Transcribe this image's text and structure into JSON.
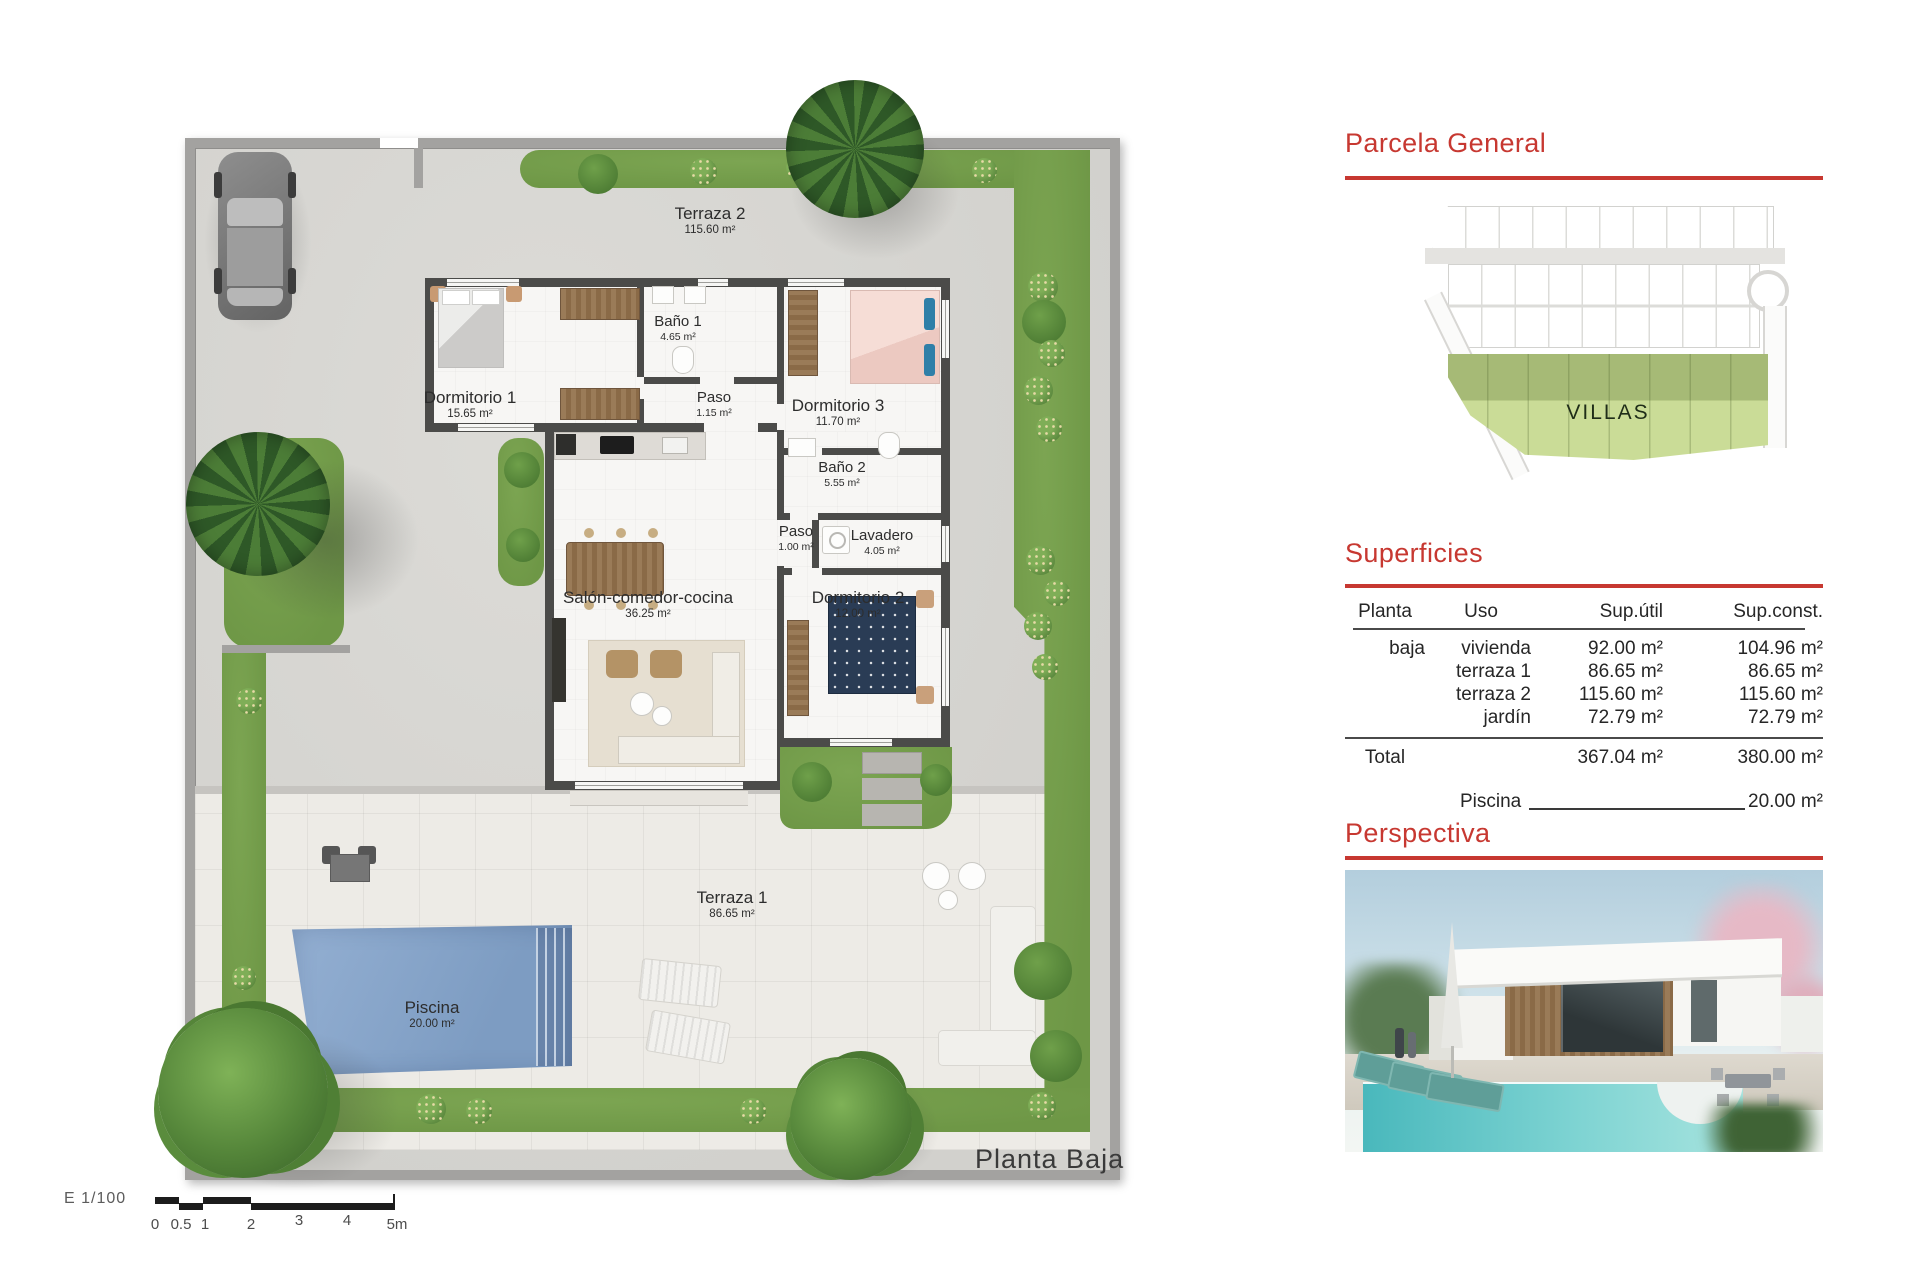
{
  "plan": {
    "caption": "Planta Baja",
    "rooms": [
      {
        "name": "Terraza 2",
        "area": "115.60 m²"
      },
      {
        "name": "Dormitorio 1",
        "area": "15.65 m²"
      },
      {
        "name": "Baño 1",
        "area": "4.65 m²"
      },
      {
        "name": "Paso",
        "area": "1.15 m²"
      },
      {
        "name": "Dormitorio 3",
        "area": "11.70 m²"
      },
      {
        "name": "Baño 2",
        "area": "5.55 m²"
      },
      {
        "name": "Paso",
        "area": "1.00 m²"
      },
      {
        "name": "Lavadero",
        "area": "4.05 m²"
      },
      {
        "name": "Salón-comedor-cocina",
        "area": "36.25 m²"
      },
      {
        "name": "Dormitorio 2",
        "area": "12.00 m²"
      },
      {
        "name": "Terraza 1",
        "area": "86.65 m²"
      },
      {
        "name": "Piscina",
        "area": "20.00 m²"
      }
    ],
    "scale": {
      "label": "E 1/100",
      "ticks": [
        "0",
        "0.5",
        "1",
        "2",
        "3",
        "4",
        "5m"
      ]
    }
  },
  "parcela": {
    "title": "Parcela General",
    "villas_label": "VILLAS"
  },
  "superficies": {
    "title": "Superficies",
    "headers": [
      "Planta",
      "Uso",
      "Sup.útil",
      "Sup.const."
    ],
    "rows": [
      {
        "planta": "baja",
        "uso": "vivienda",
        "sup_util": "92.00 m²",
        "sup_const": "104.96 m²"
      },
      {
        "planta": "",
        "uso": "terraza 1",
        "sup_util": "86.65 m²",
        "sup_const": "86.65 m²"
      },
      {
        "planta": "",
        "uso": "terraza 2",
        "sup_util": "115.60 m²",
        "sup_const": "115.60 m²"
      },
      {
        "planta": "",
        "uso": "jardín",
        "sup_util": "72.79 m²",
        "sup_const": "72.79 m²"
      }
    ],
    "total": {
      "label": "Total",
      "sup_util": "367.04 m²",
      "sup_const": "380.00 m²"
    },
    "piscina": {
      "label": "Piscina",
      "value": "20.00 m²"
    }
  },
  "perspectiva": {
    "title": "Perspectiva"
  },
  "colors": {
    "accent_red": "#c73831",
    "wall_dark": "#4b4b49",
    "boundary_wall": "#a3a2a0",
    "grass_green": "#76a04c",
    "pool_blue": "#8aa7cb",
    "concrete": "#d8d7d3",
    "terrace_tiles": "#edebe6",
    "villas_dark": "#a6ba76",
    "villas_light": "#cadc97"
  }
}
